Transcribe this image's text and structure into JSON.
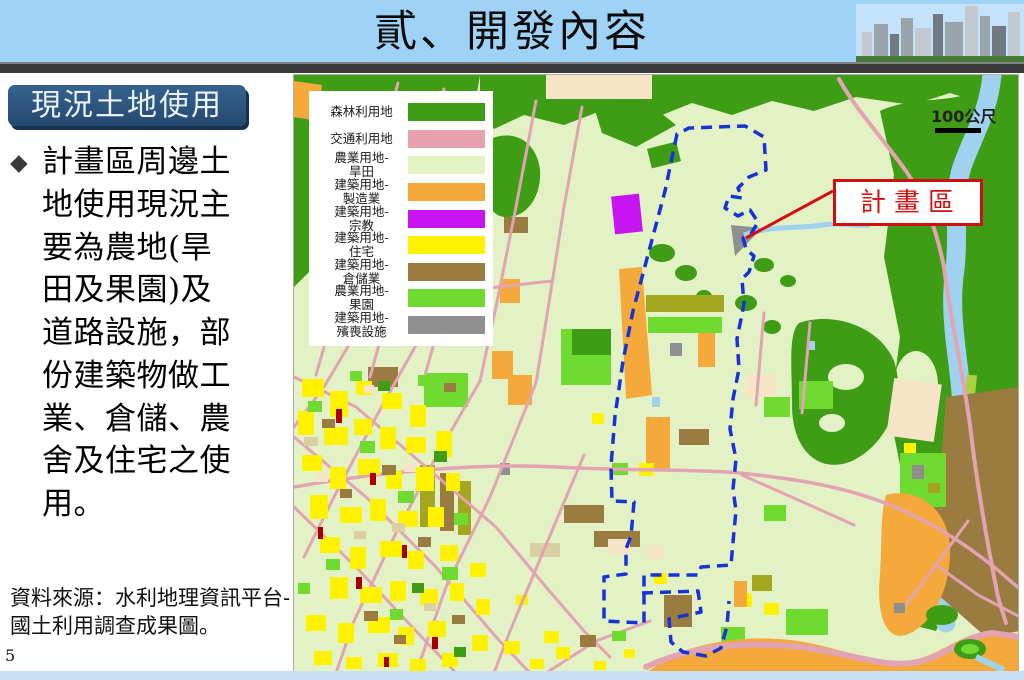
{
  "slide": {
    "title": "貳、開發內容",
    "page_number": "5"
  },
  "sidebar": {
    "heading": "現況土地使用",
    "bullet_icon": "◆",
    "paragraph": "計畫區周邊土地使用現況主要為農地(旱田及果園)及道路設施，部份建築物做工業、倉儲、農舍及住宅之使用。",
    "source": "資料來源：水利地理資訊平台-國土利用調查成果圖。"
  },
  "map": {
    "scale_label": "100公尺",
    "callout_label": "計畫區",
    "boundary_color": "#1733D6",
    "callout_color": "#D01010",
    "legend": {
      "items": [
        {
          "label_line1": "森林利用地",
          "label_line2": "",
          "color": "#3E9C15"
        },
        {
          "label_line1": "交通利用地",
          "label_line2": "",
          "color": "#E8A2AE"
        },
        {
          "label_line1": "農業用地-",
          "label_line2": "旱田",
          "color": "#E2F4C3"
        },
        {
          "label_line1": "建築用地-",
          "label_line2": "製造業",
          "color": "#F5A93B"
        },
        {
          "label_line1": "建築用地-",
          "label_line2": "宗教",
          "color": "#C714F0"
        },
        {
          "label_line1": "建築用地-",
          "label_line2": "住宅",
          "color": "#FFF200"
        },
        {
          "label_line1": "建築用地-",
          "label_line2": "倉儲業",
          "color": "#9A7B40"
        },
        {
          "label_line1": "農業用地-",
          "label_line2": "果園",
          "color": "#6FDB30"
        },
        {
          "label_line1": "建築用地-",
          "label_line2": "殯喪設施",
          "color": "#8F8F8F"
        }
      ]
    }
  }
}
